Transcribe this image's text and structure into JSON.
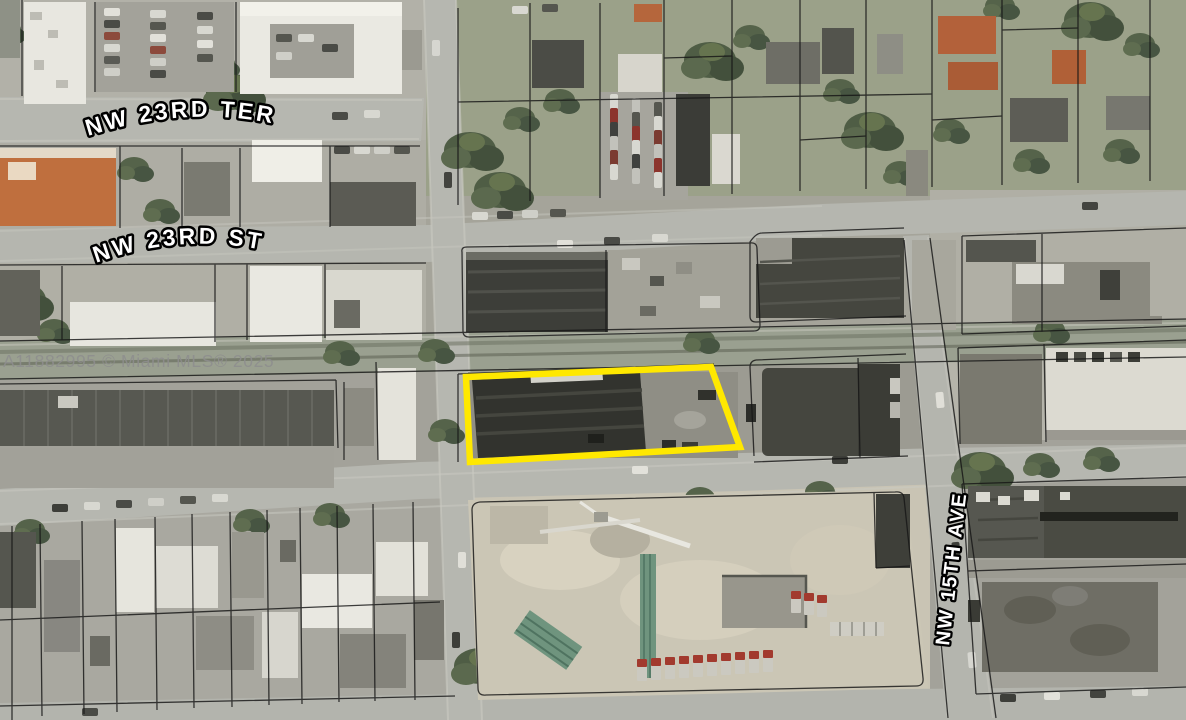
{
  "map": {
    "watermark": "A11882995 © Miami MLS® 2025",
    "street_labels": [
      {
        "id": "nw-23rd-ter",
        "text": "NW 23RD TER",
        "orientation": "horizontal"
      },
      {
        "id": "nw-23rd-st",
        "text": "NW 23RD ST",
        "orientation": "horizontal"
      },
      {
        "id": "nw-15th-ave",
        "text": "NW 15TH AVE",
        "orientation": "vertical"
      }
    ],
    "highlight_parcel": {
      "label": "subject-property-boundary",
      "color": "#FFE800"
    },
    "colors": {
      "street_label_fill": "#FFFFFF",
      "street_label_outline": "#000000",
      "parcel_line": "#161616",
      "watermark_gray": "#8E8E8E"
    }
  }
}
